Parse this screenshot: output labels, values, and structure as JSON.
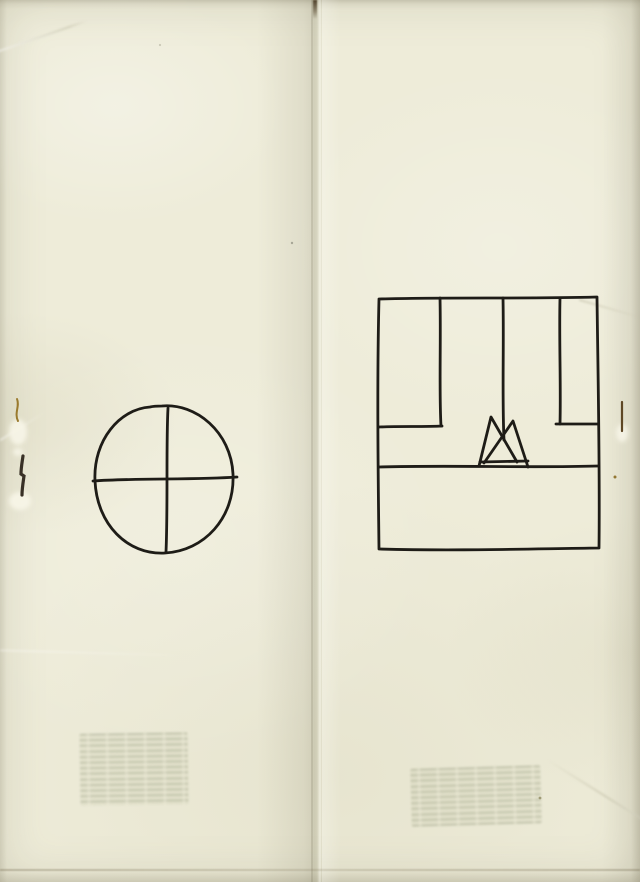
{
  "document": {
    "title": "Scanned saddle-stapled booklet spread with two hand-drawn ink figures",
    "legible_text": "",
    "pages": [
      {
        "side": "left",
        "figure": "circle-quartered-by-cross",
        "ghost_text": "illegible show-through paragraph block"
      },
      {
        "side": "right",
        "figure": "partitioned-square-with-two-triangles",
        "ghost_text": "illegible show-through paragraph block"
      }
    ]
  },
  "colors": {
    "paper": "#eeecd9",
    "paper_deep": "#e2e0ca",
    "seam": "#d5d4c0",
    "ink": "#1e1c17",
    "rust": "#9a7a2e",
    "staple_dark": "#383026",
    "staple_right": "#5e4724",
    "ghost": "#cfd0b8"
  },
  "figures": [
    {
      "name": "figure-circle-with-cross",
      "stroke": "#1e1c17",
      "width": 2.8,
      "paths": [
        "M162 406 C196 403 231 432 233 474 C235 518 204 551 165 553 C127 555 97 524 95 481 C93 440 120 409 150 407 C154 406 158 406 162 406",
        "M168 408 C166 445 168 505 166 552",
        "M93 481 C135 478 195 480 237 477"
      ]
    },
    {
      "name": "figure-partitioned-square-triangles",
      "stroke": "#1e1c17",
      "width": 2.8,
      "paths": [
        "M379 299 C448 297 525 299 597 297 C598 378 600 468 599 548 C522 549 452 551 379 549 C378 468 377 378 379 299",
        "M440 298 C441 342 439 392 441 426",
        "M379 427 C400 426 424 427 442 426",
        "M503 298 C504 348 502 398 504 440",
        "M560 298 C559 340 561 384 560 424",
        "M556 424 C570 424 585 424 598 424",
        "M379 467 C450 465 530 468 598 466",
        "M479 466 L491 417 L517 462",
        "M484 463 L513 421 L528 467",
        "M480 462 L528 461"
      ]
    }
  ],
  "marks": [
    {
      "name": "paper-tear-highlight-left-upper",
      "kind": "glow",
      "cx": 18,
      "cy": 432,
      "rx": 9,
      "ry": 13,
      "fill": "#f8f6e8",
      "opacity": 0.9
    },
    {
      "name": "paper-tear-highlight-left-top",
      "kind": "glow",
      "cx": 18,
      "cy": 452,
      "rx": 5,
      "ry": 4,
      "fill": "#f8f6e8",
      "opacity": 0.85
    },
    {
      "name": "paper-tear-highlight-left-lower",
      "kind": "glow",
      "cx": 20,
      "cy": 501,
      "rx": 11,
      "ry": 9,
      "fill": "#f8f6e8",
      "opacity": 0.9
    },
    {
      "name": "paper-tear-highlight-right",
      "kind": "glow",
      "cx": 622,
      "cy": 433,
      "rx": 6,
      "ry": 9,
      "fill": "#f8f6e8",
      "opacity": 0.85
    },
    {
      "name": "staple-left-rust-fragment",
      "kind": "path",
      "d": "M17 399 C20 406 14 413 18 421",
      "stroke": "#9a7a2e",
      "width": 2
    },
    {
      "name": "staple-left",
      "kind": "path",
      "d": "M23 456 C22 463 21 468 21 474 L24 476 C23 483 22 489 22 495",
      "stroke": "#383026",
      "width": 3.2
    },
    {
      "name": "staple-right",
      "kind": "path",
      "d": "M622 402 C622 412 622 422 622 431",
      "stroke": "#5e4724",
      "width": 2.2
    },
    {
      "name": "rust-speck-right-edge",
      "kind": "dot",
      "cx": 615,
      "cy": 477,
      "r": 1.5,
      "fill": "#8a6a20",
      "opacity": 0.9
    },
    {
      "name": "speck-right-page-bottom",
      "kind": "dot",
      "cx": 540,
      "cy": 798,
      "r": 1.4,
      "fill": "#8f8a60",
      "opacity": 0.8
    },
    {
      "name": "speck-left-page-mid",
      "kind": "dot",
      "cx": 292,
      "cy": 243,
      "r": 1.2,
      "fill": "#999788",
      "opacity": 0.8
    },
    {
      "name": "fiber-speck-top-left",
      "kind": "dot",
      "cx": 160,
      "cy": 45,
      "r": 1.1,
      "fill": "#b3af9c",
      "opacity": 0.6
    }
  ]
}
